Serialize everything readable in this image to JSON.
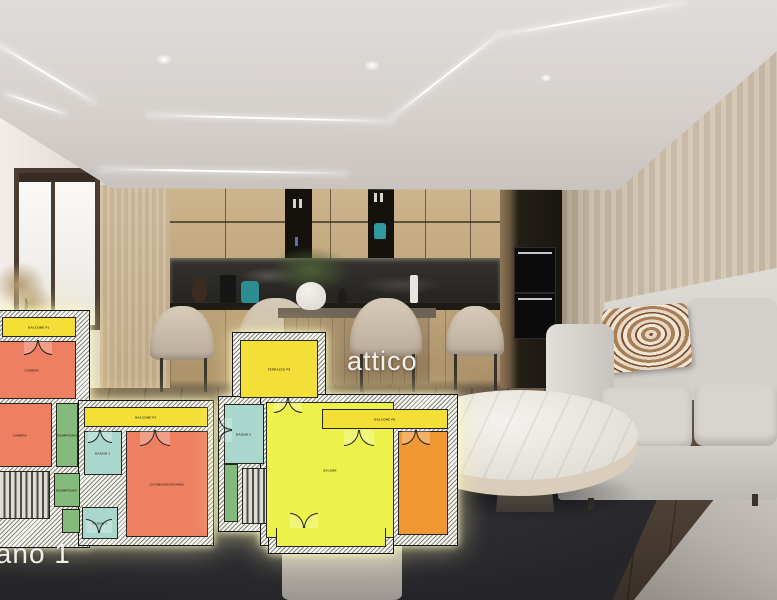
{
  "titles": {
    "attico": "attico",
    "piano1": "piano 1"
  },
  "floorplan_piano1": {
    "rooms": [
      {
        "key": "balcone-a",
        "label": "BALCONE P1",
        "color": "#f4df37"
      },
      {
        "key": "camera-1",
        "label": "CAMERA",
        "color": "#ee7f63"
      },
      {
        "key": "camera-2",
        "label": "CAMERA",
        "color": "#ee7f63"
      },
      {
        "key": "disimpegno-1",
        "label": "DISIMPEGNO",
        "color": "#84ba7b"
      },
      {
        "key": "balcone-b",
        "label": "BALCONE P1",
        "color": "#f4df37"
      },
      {
        "key": "bagno-1",
        "label": "BAGNO 1",
        "color": "#a9d7ce"
      },
      {
        "key": "disimpegno-2",
        "label": "DISIMPEGNO",
        "color": "#84ba7b"
      },
      {
        "key": "bagno-2",
        "label": "BAGNO 2",
        "color": "#a9d7ce"
      },
      {
        "key": "cucina",
        "label": "CUCINA/SOGGIORNO",
        "color": "#ee7f63"
      },
      {
        "key": "scala",
        "label": "",
        "color": "stairs-hatch"
      }
    ]
  },
  "floorplan_attico": {
    "rooms": [
      {
        "key": "terrazzo",
        "label": "TERRAZZO P2",
        "color": "#f4df37"
      },
      {
        "key": "bagno-3",
        "label": "BAGNO 3",
        "color": "#a9d7ce"
      },
      {
        "key": "salone",
        "label": "SALONE",
        "color": "#edf24b"
      },
      {
        "key": "balcone",
        "label": "BALCONE P2",
        "color": "#f4df37"
      },
      {
        "key": "camera",
        "label": "",
        "color": "#ef9733"
      },
      {
        "key": "scala",
        "label": "",
        "color": "stairs-hatch"
      }
    ]
  },
  "palette": {
    "plan_wall_hatch": "#87857d",
    "glow": "#fff6aa",
    "rug": "#26262a",
    "wood_floor": "#55463a",
    "sofa": "#d8d5d0",
    "right_wall": "#d2c5b1",
    "cabinet_wood": "#c3a97f",
    "backsplash": "#242320"
  }
}
